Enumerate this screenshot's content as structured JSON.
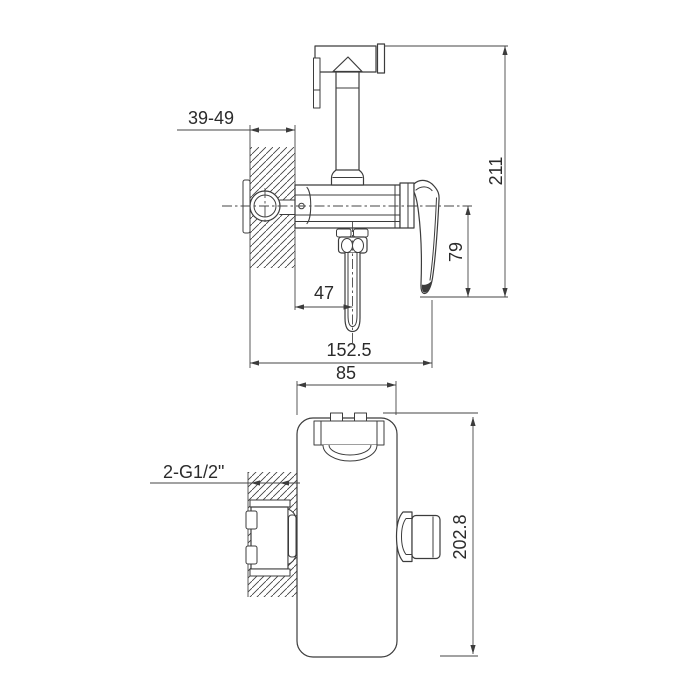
{
  "colors": {
    "background": "#ffffff",
    "line": "#3c3c3c",
    "dimension_text": "#2b2b2b"
  },
  "side_view": {
    "dim_wall_depth": "39-49",
    "dim_total_height": "211",
    "dim_handle_height": "79",
    "dim_hose_offset": "47",
    "dim_total_depth": "152.5"
  },
  "front_view": {
    "dim_body_width": "85",
    "dim_total_height": "202.8",
    "label_connections": "2-G1/2\""
  }
}
